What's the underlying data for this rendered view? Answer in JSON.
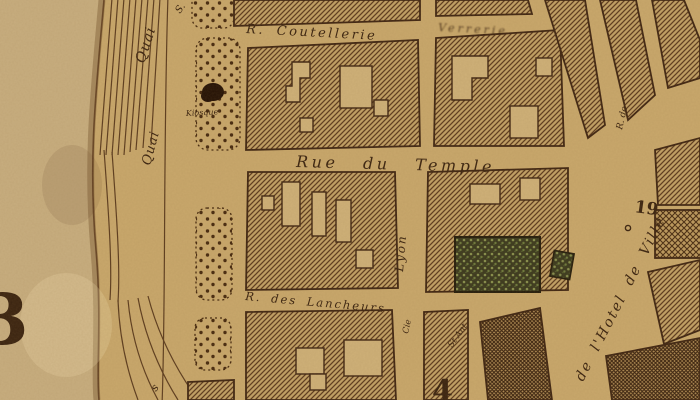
{
  "map": {
    "title": "Vintage engraved city-map detail (sepia plan, Rue du Temple quarter)",
    "palette": {
      "paper": "#c9a86c",
      "margin_paper": "#c8ae80",
      "ink": "#3a2310",
      "wall_stroke": "#3f2512",
      "hatch_line": "#5d3b1f",
      "hatch_bg": "#c2a166",
      "highlight_building_bg": "#3a391e",
      "highlight_building_dot": "#87904e",
      "kiosque_marker": "#241105"
    },
    "labels": {
      "quai_upper": "Quai",
      "quai_lower": "Quai",
      "quai_suffix_s": "S.",
      "quai_letter_s": "s",
      "kiosque": "Kiosque",
      "rue_coutellerie": "R. Coutellerie",
      "rue_smudged": "Verrerie",
      "rue_du_temple": "Rue du Temple",
      "rue_lyon": "Lyon",
      "rue_des_lancheurs": "R. des Lancheurs",
      "rue_hotel_de_ville": "de l'Hotel de Ville",
      "rue_de_partial": "R. de",
      "label_st_ant": "St Ant",
      "label_cie": "Cie"
    },
    "numbers": {
      "ref_19": "19",
      "block_4": "4",
      "margin_glyph": "3"
    }
  }
}
